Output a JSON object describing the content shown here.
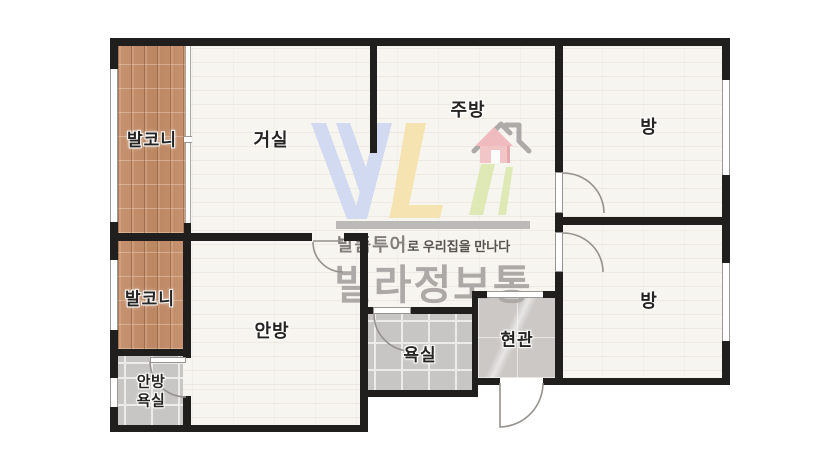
{
  "floor_plan": {
    "type": "apartment-floor-plan",
    "rooms": [
      {
        "id": "balcony-top",
        "label": "발코니"
      },
      {
        "id": "living-room",
        "label": "거실"
      },
      {
        "id": "kitchen",
        "label": "주방"
      },
      {
        "id": "room-top-right",
        "label": "방"
      },
      {
        "id": "balcony-bottom",
        "label": "발코니"
      },
      {
        "id": "master-bedroom",
        "label": "안방"
      },
      {
        "id": "master-bath-line1",
        "label": "안방"
      },
      {
        "id": "master-bath-line2",
        "label": "욕실"
      },
      {
        "id": "bathroom",
        "label": "욕실"
      },
      {
        "id": "entrance",
        "label": "현관"
      },
      {
        "id": "room-bottom-right",
        "label": "방"
      }
    ],
    "watermark": {
      "logo_letters": "VL",
      "tagline_emphasis": "발품투어",
      "tagline_rest": "로 우리집을 만나다",
      "brand": "빌라정보통"
    },
    "colors": {
      "wall": "#211f1d",
      "floor": "#f7f5f0",
      "balcony_wood": "#c28e6b",
      "bath_tile": "#c7c6c4",
      "entry_marble": "#cbc8c5",
      "logo_blue": "#ccd7f0",
      "logo_yellow": "#f5e1a9",
      "logo_green": "#dbe8ad",
      "logo_pink": "#f1b9bc",
      "watermark_gray": "#aca9a6"
    }
  }
}
